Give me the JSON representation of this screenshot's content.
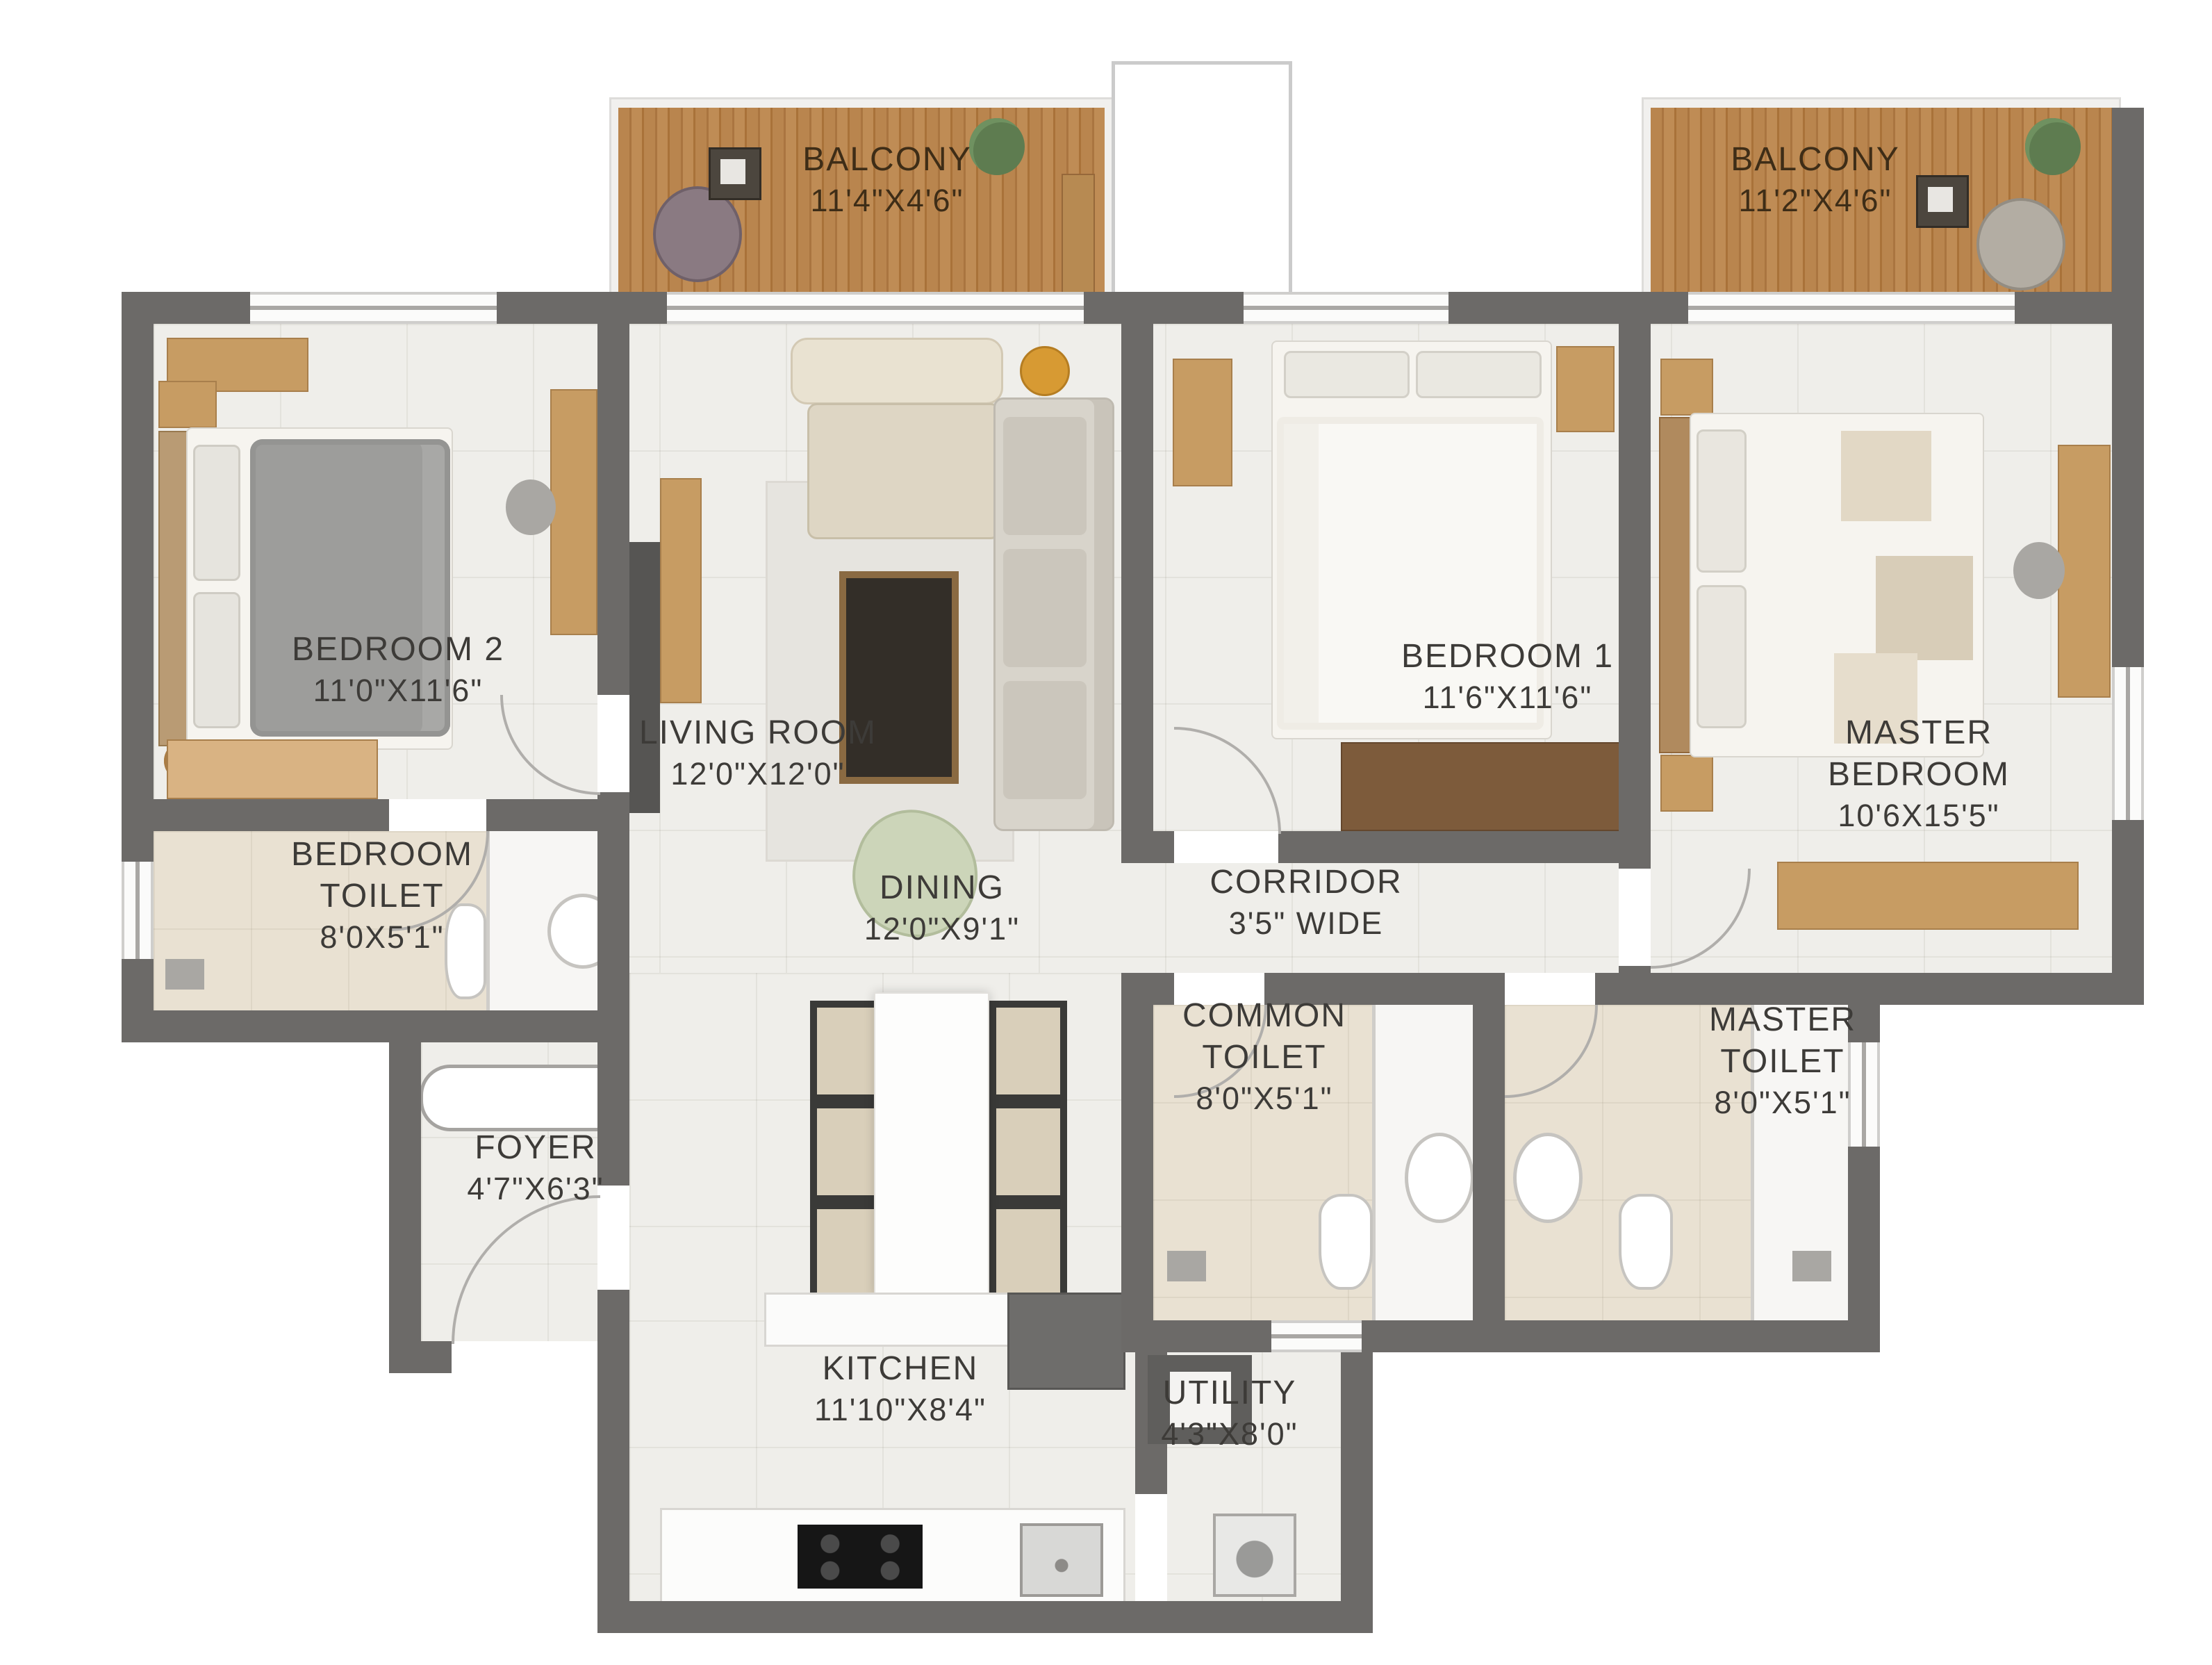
{
  "plan": {
    "type": "residential-floor-plan",
    "rooms": [
      {
        "key": "balcony_left",
        "label": "BALCONY",
        "dims": "11'4\"X4'6\""
      },
      {
        "key": "balcony_right",
        "label": "BALCONY",
        "dims": "11'2\"X4'6\""
      },
      {
        "key": "bedroom_2",
        "label": "BEDROOM 2",
        "dims": "11'0\"X11'6\""
      },
      {
        "key": "living_room",
        "label": "LIVING ROOM",
        "dims": "12'0\"X12'0\""
      },
      {
        "key": "bedroom_1",
        "label": "BEDROOM 1",
        "dims": "11'6\"X11'6\""
      },
      {
        "key": "master_bedroom",
        "label": "MASTER BEDROOM",
        "dims": "10'6X15'5\""
      },
      {
        "key": "bedroom_toilet",
        "label": "BEDROOM TOILET",
        "dims": "8'0X5'1\""
      },
      {
        "key": "corridor",
        "label": "CORRIDOR",
        "dims": "3'5\" WIDE"
      },
      {
        "key": "dining",
        "label": "DINING",
        "dims": "12'0\"X9'1\""
      },
      {
        "key": "common_toilet",
        "label": "COMMON TOILET",
        "dims": "8'0\"X5'1\""
      },
      {
        "key": "master_toilet",
        "label": "MASTER TOILET",
        "dims": "8'0\"X5'1\""
      },
      {
        "key": "foyer",
        "label": "FOYER",
        "dims": "4'7\"X6'3\""
      },
      {
        "key": "kitchen",
        "label": "KITCHEN",
        "dims": "11'10\"X8'4\""
      },
      {
        "key": "utility",
        "label": "UTILITY",
        "dims": "4'3\"X8'0\""
      }
    ],
    "colors": {
      "wall": "#6c6a68",
      "floor": "#efeeea",
      "toilet_floor": "#e9e1d2",
      "balcony_wood": "#b2804a",
      "label_text": "#3d3b38",
      "balcony_label_text": "#3e2d17"
    }
  }
}
